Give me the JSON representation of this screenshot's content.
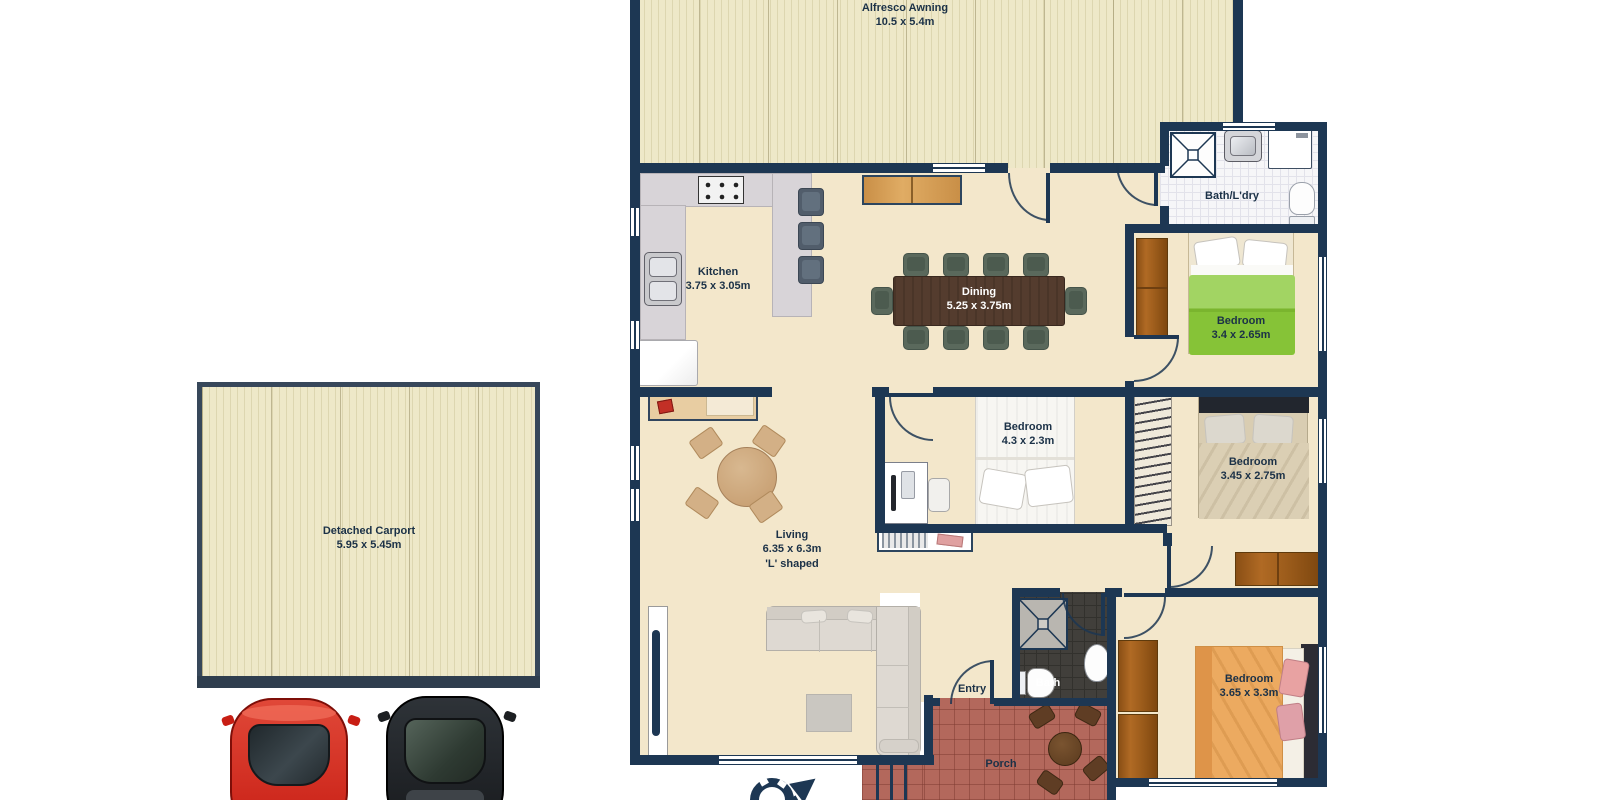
{
  "colors": {
    "wall": "#1d3753",
    "label": "#1b3147",
    "floor": "#f3e7cb",
    "stripe": "#eee8c8",
    "stripeline": "#ddd6b0",
    "porch": "#b3685c",
    "tile": "#f6f6f8",
    "darktile": "#413f3b",
    "green": "#8cc63e",
    "orange": "#ecaa60",
    "carred": "#d5281e",
    "carblack": "#24282c"
  },
  "rooms": {
    "alfresco": {
      "name": "Alfresco Awning",
      "dims": "10.5 x 5.4m"
    },
    "bath_laundry": {
      "name": "Bath/L'dry"
    },
    "kitchen": {
      "name": "Kitchen",
      "dims": "3.75 x 3.05m"
    },
    "dining": {
      "name": "Dining",
      "dims": "5.25 x 3.75m"
    },
    "bedroom_green": {
      "name": "Bedroom",
      "dims": "3.4 x 2.65m"
    },
    "bedroom_mid": {
      "name": "Bedroom",
      "dims": "4.3 x 2.3m"
    },
    "bedroom_right": {
      "name": "Bedroom",
      "dims": "3.45 x 2.75m"
    },
    "living": {
      "name": "Living",
      "dims": "6.35 x 6.3m",
      "note": "'L' shaped"
    },
    "entry": {
      "name": "Entry"
    },
    "bath": {
      "name": "Bath"
    },
    "porch": {
      "name": "Porch"
    },
    "bedroom_front": {
      "name": "Bedroom",
      "dims": "3.65 x 3.3m"
    },
    "carport": {
      "name": "Detached Carport",
      "dims": "5.95 x 5.45m"
    }
  }
}
